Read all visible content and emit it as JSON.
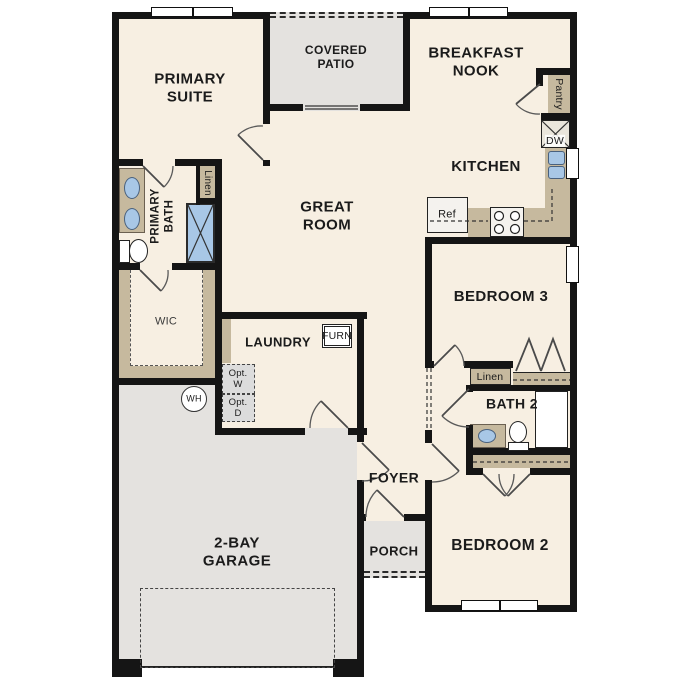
{
  "rooms": {
    "primary_suite": "PRIMARY SUITE",
    "covered_patio": "COVERED PATIO",
    "breakfast_nook": "BREAKFAST NOOK",
    "kitchen": "KITCHEN",
    "great_room": "GREAT ROOM",
    "primary_bath": "PRIMARY BATH",
    "wic": "WIC",
    "laundry": "LAUNDRY",
    "bedroom_3": "BEDROOM 3",
    "bath_2": "BATH 2",
    "bedroom_2": "BEDROOM 2",
    "foyer": "FOYER",
    "porch": "PORCH",
    "garage": "2-BAY GARAGE"
  },
  "labels": {
    "linen_primary": "Linen",
    "linen_hall": "Linen",
    "pantry": "Pantry",
    "dishwasher": "DW",
    "refrigerator": "Ref",
    "furnace": "FURN",
    "optional_washer": "Opt. W",
    "optional_dryer": "Opt. D",
    "water_heater": "WH"
  },
  "colors": {
    "wall": "#151515",
    "room_fill": "#f7efe2",
    "concrete_fill": "#e4e2df",
    "cabinet_tan": "#c6b99e",
    "fixture_blue": "#a8c7e6"
  }
}
